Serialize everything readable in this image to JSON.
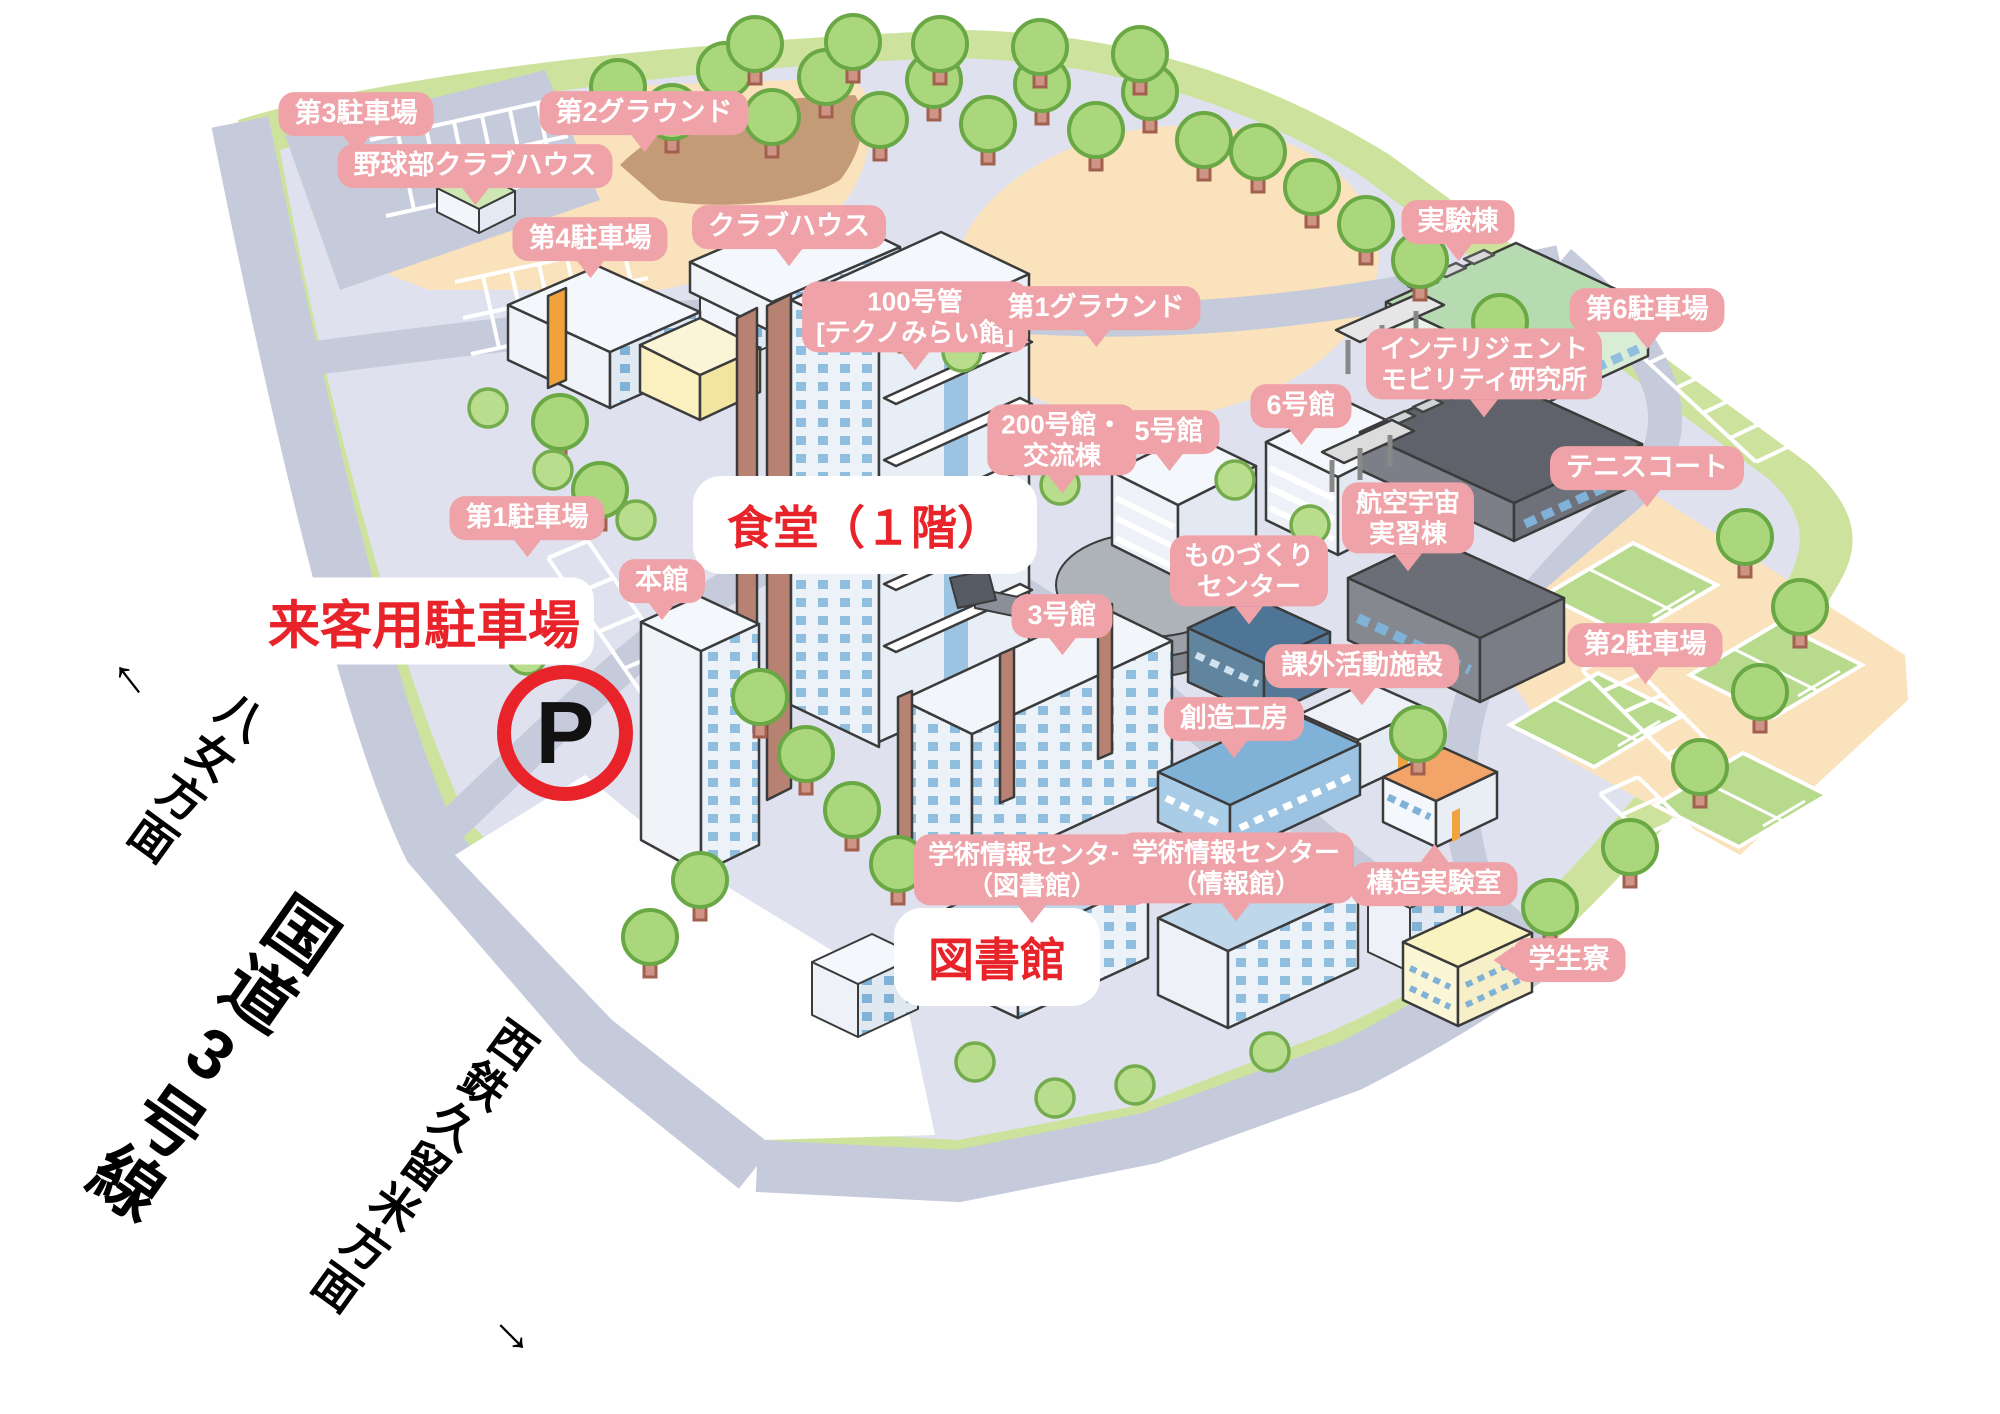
{
  "map_title": "campus illustrated map",
  "colors": {
    "label_pink": "#EFA2A7",
    "label_text": "#FFFFFF",
    "highlight_red": "#E8232A",
    "road_gray": "#C6CBDB",
    "grass_green": "#CDE39D",
    "ground_orange": "#FAE2BC",
    "campus_base": "#DFE2EE"
  },
  "labels": [
    {
      "id": "dai3-parking",
      "l1": "第3駐車場"
    },
    {
      "id": "dai2-ground",
      "l1": "第2グラウンド"
    },
    {
      "id": "yakyubu-clubhouse",
      "l1": "野球部クラブハウス"
    },
    {
      "id": "dai4-parking",
      "l1": "第4駐車場"
    },
    {
      "id": "clubhouse",
      "l1": "クラブハウス"
    },
    {
      "id": "jikkento",
      "l1": "実験棟"
    },
    {
      "id": "building-100",
      "l1": "100号管",
      "l2": "[テクノみらい館]"
    },
    {
      "id": "dai1-ground",
      "l1": "第1グラウンド"
    },
    {
      "id": "intelligent-mobility",
      "l1": "インテリジェント",
      "l2": "モビリティ研究所"
    },
    {
      "id": "dai6-parking",
      "l1": "第6駐車場"
    },
    {
      "id": "building-200",
      "l1": "200号館・",
      "l2": "交流棟"
    },
    {
      "id": "building-5",
      "l1": "5号館"
    },
    {
      "id": "building-6",
      "l1": "6号館"
    },
    {
      "id": "tennis-court",
      "l1": "テニスコート"
    },
    {
      "id": "dai1-parking",
      "l1": "第1駐車場"
    },
    {
      "id": "honkan",
      "l1": "本館"
    },
    {
      "id": "monozukuri-center",
      "l1": "ものづくり",
      "l2": "センター"
    },
    {
      "id": "koku-uchu",
      "l1": "航空宇宙",
      "l2": "実習棟"
    },
    {
      "id": "dai2-parking",
      "l1": "第2駐車場"
    },
    {
      "id": "building-3",
      "l1": "3号館"
    },
    {
      "id": "kagai-katsudo",
      "l1": "課外活動施設"
    },
    {
      "id": "souzou-kobo",
      "l1": "創造工房"
    },
    {
      "id": "gakujutsu-toshokan",
      "l1": "学術情報センター",
      "l2": "（図書館）"
    },
    {
      "id": "gakujutsu-johokan",
      "l1": "学術情報センター",
      "l2": "（情報館）"
    },
    {
      "id": "kozo-jikken",
      "l1": "構造実験室"
    },
    {
      "id": "gakusei-ryo",
      "l1": "学生寮"
    }
  ],
  "highlight": {
    "shokudo": "食堂（１階）",
    "raikyaku": "来客用駐車場",
    "tosho": "図書館",
    "parking_mark": "P"
  },
  "roads": {
    "yame": {
      "arrow": "↑",
      "text": "八女方面"
    },
    "kokudo": {
      "text": "国道3号線"
    },
    "nishitetsu": {
      "text": "西鉄久留米方面",
      "arrow": "→"
    }
  }
}
